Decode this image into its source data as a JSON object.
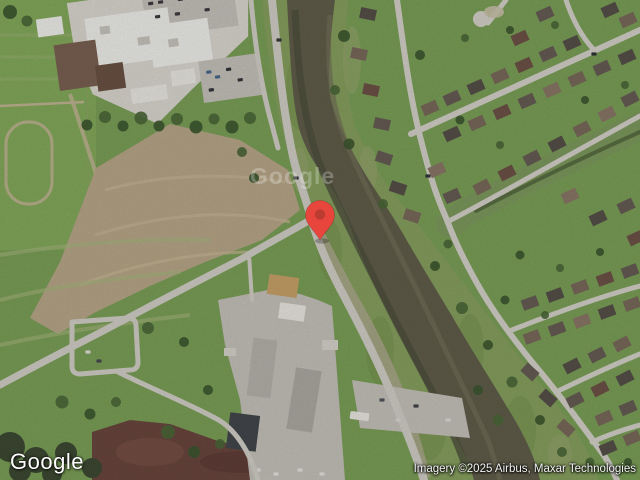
{
  "map": {
    "view_type": "satellite",
    "description": "Aerial satellite view: school campus and open fields on the left, a brown drainage channel (bayou) curving from top center to bottom right, a residential street grid on the right, and industrial buildings at bottom center",
    "marker": {
      "label": "dropped-pin",
      "x_px": 320,
      "y_px": 240
    }
  },
  "logo": {
    "text": "Google"
  },
  "watermark": {
    "text": "Google"
  },
  "attribution": {
    "text": "Imagery ©2025 Airbus, Maxar Technologies"
  },
  "colors": {
    "grass": "#7CA158",
    "field": "#84AB5C",
    "dry": "#A9B87E",
    "dirt": "#B9A88A",
    "dirt_streak": "#C9B997",
    "maroon": "#6B473F",
    "bank": "#87A15F",
    "trib": "#7E9B5E",
    "ditch": "#5A6F42",
    "water": "#615E4B",
    "water_dark": "#50503F",
    "water_light": "#73705A",
    "gravel": "#B2AB92",
    "road": "#D3D0C8",
    "street": "#D6D3CB",
    "concrete": "#DCD9D1",
    "lot": "#C7C4BC",
    "roof_white": "#F1F0EC",
    "roof_brown": "#7B6152",
    "roof_brown2": "#6B5244",
    "roof_tan": "#C9A36A",
    "warehouse": "#B7B4AC",
    "industrial": "#43474B",
    "tree": "#4C6838",
    "tree_dark": "#3D5830",
    "pin": "#E8453C",
    "pin_inner": "#BC3B30"
  }
}
